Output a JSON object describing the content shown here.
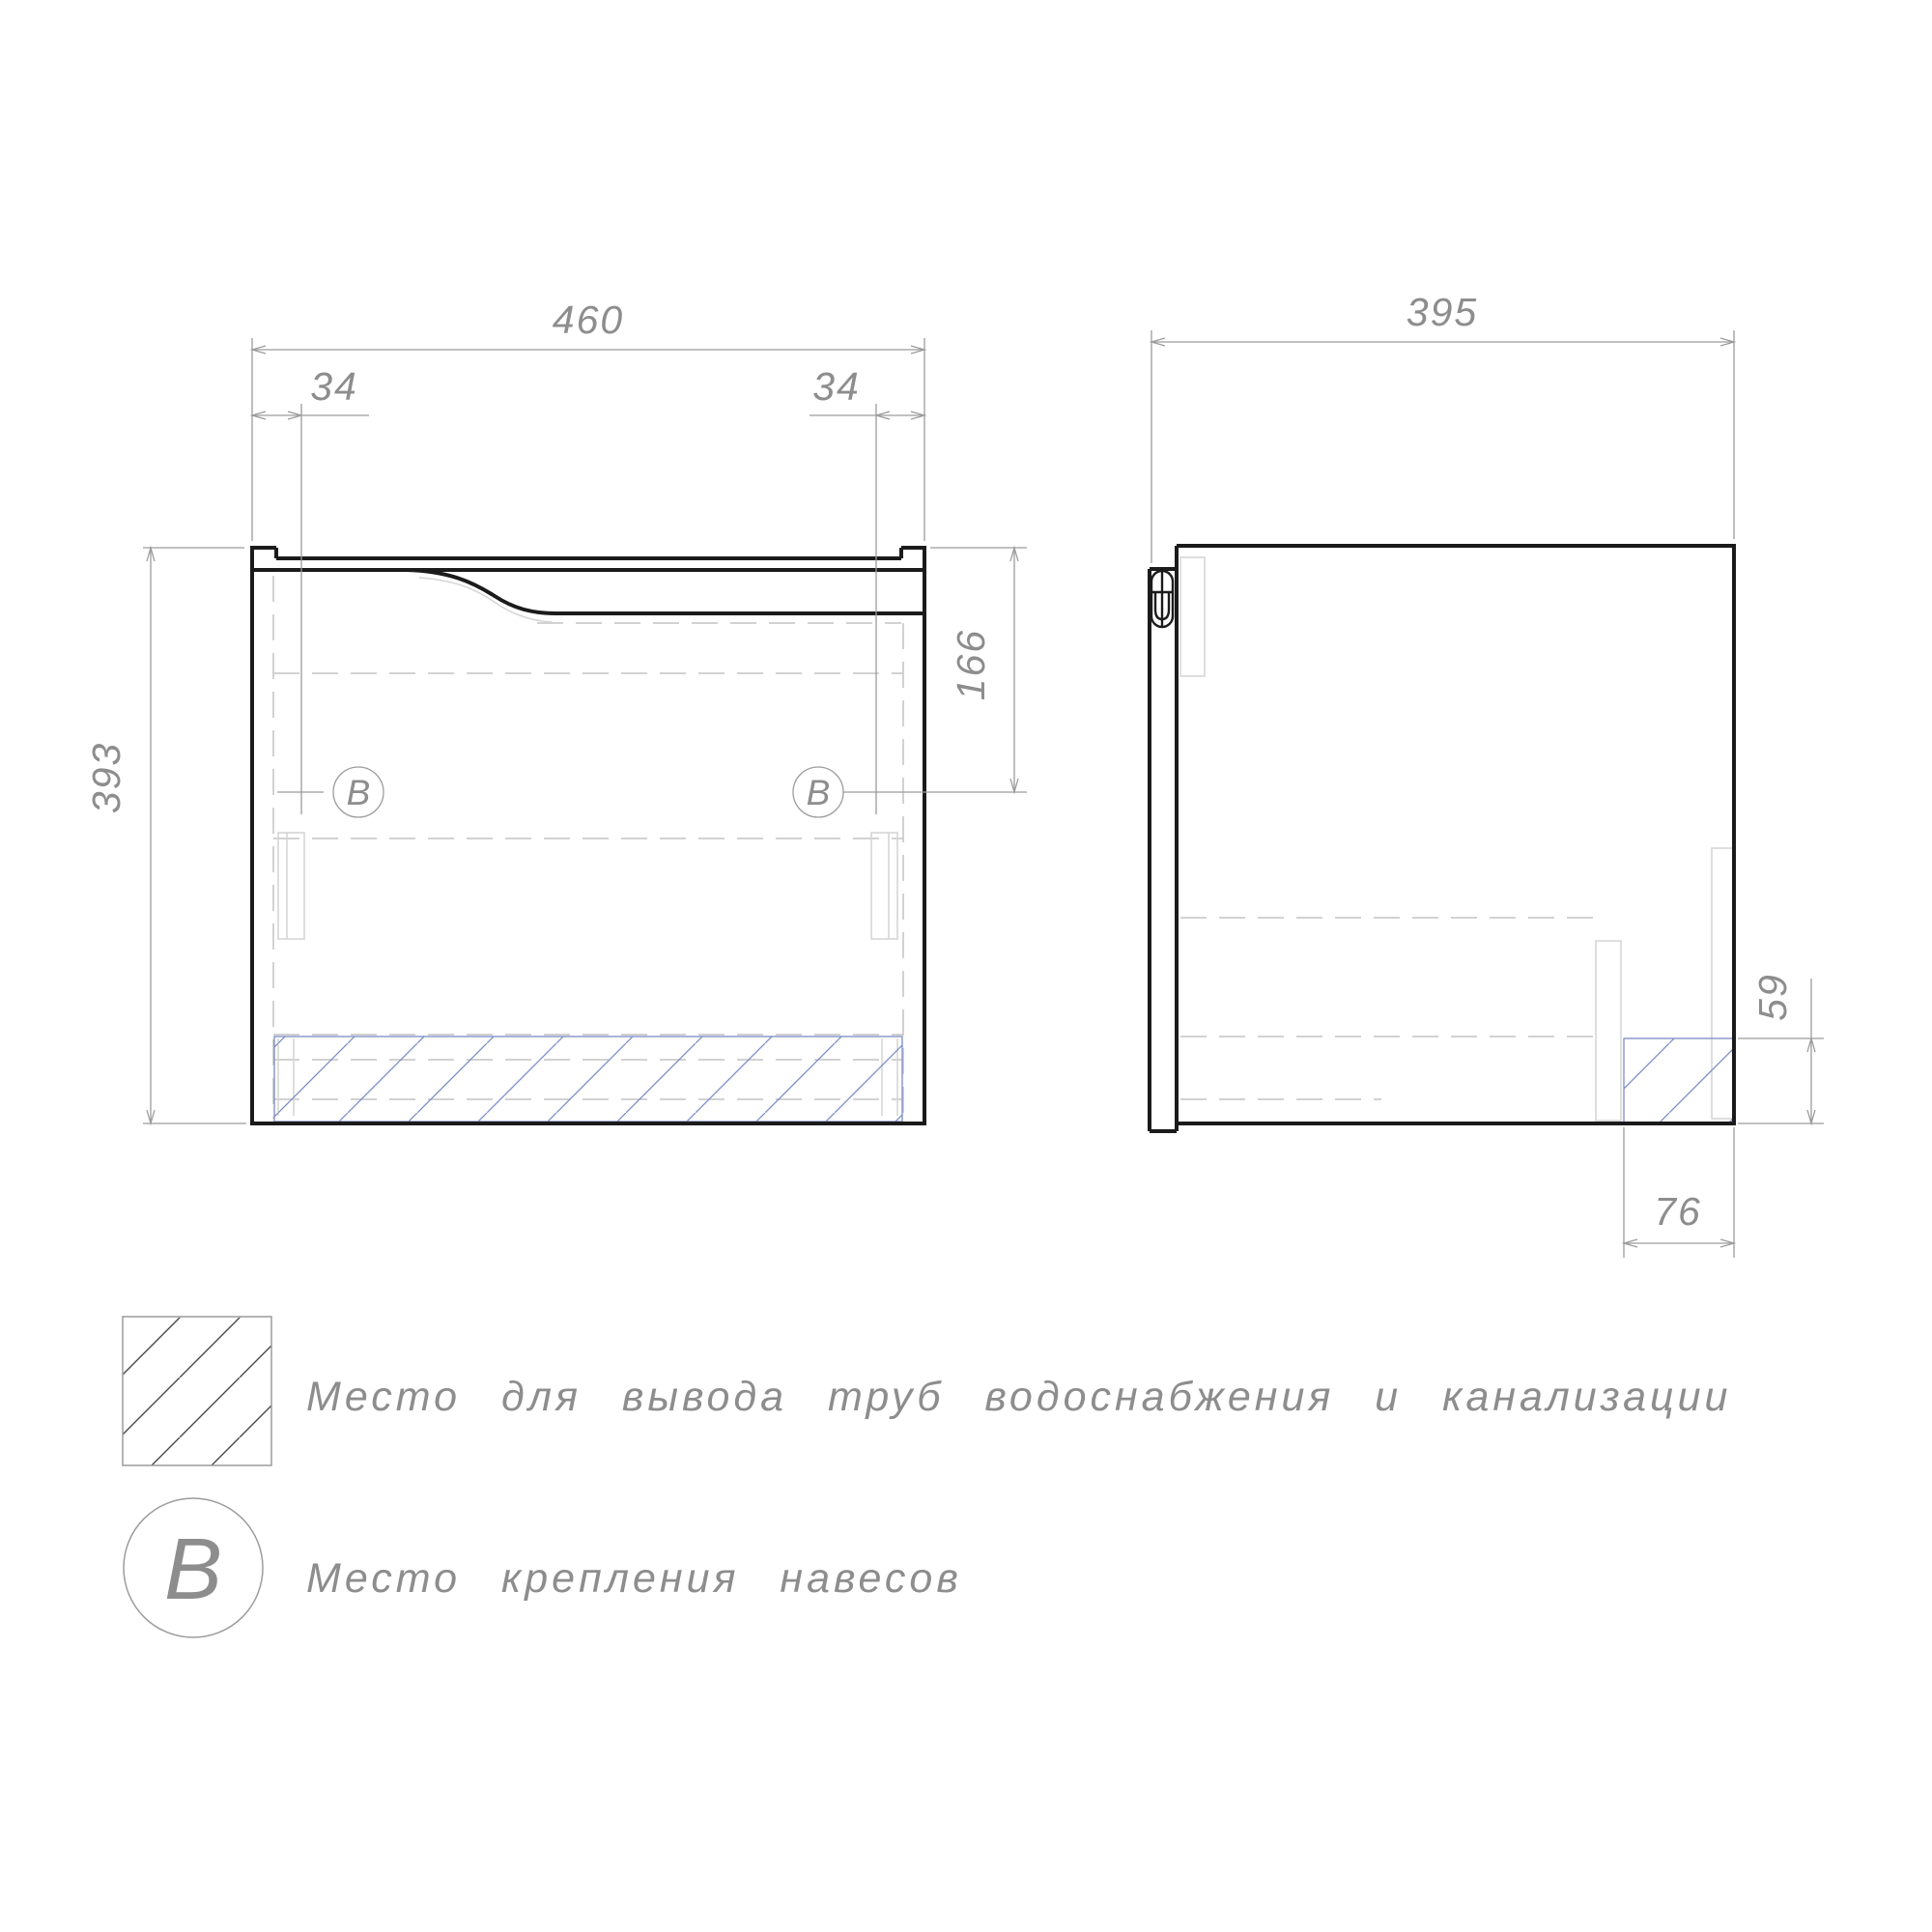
{
  "drawing_type": "furniture technical drawing, bathroom vanity cabinet, front and side views",
  "dimensions": {
    "front_width": "460",
    "front_mount_offset_left": "34",
    "front_mount_offset_right": "34",
    "front_height": "393",
    "front_mount_drop": "166",
    "side_depth": "395",
    "side_cutout_height": "59",
    "side_cutout_width": "76"
  },
  "markers": {
    "mount_point": "B"
  },
  "legend": {
    "pipe_zone_symbol": "diagonal-hatch-square",
    "pipe_zone_text": "Место для вывода труб водоснабжения и канализации",
    "mount_symbol": "B",
    "mount_text": "Место крепления навесов"
  },
  "colors": {
    "outline": "#1b1b1b",
    "dimension": "#9c9c9c",
    "dim_text": "#8d8d8d",
    "hidden": "#cbcbcb",
    "hidden_light": "#d6d6d6",
    "hatch_blue": "#7b8cc4",
    "legend_hatch": "#4a4a4a"
  }
}
